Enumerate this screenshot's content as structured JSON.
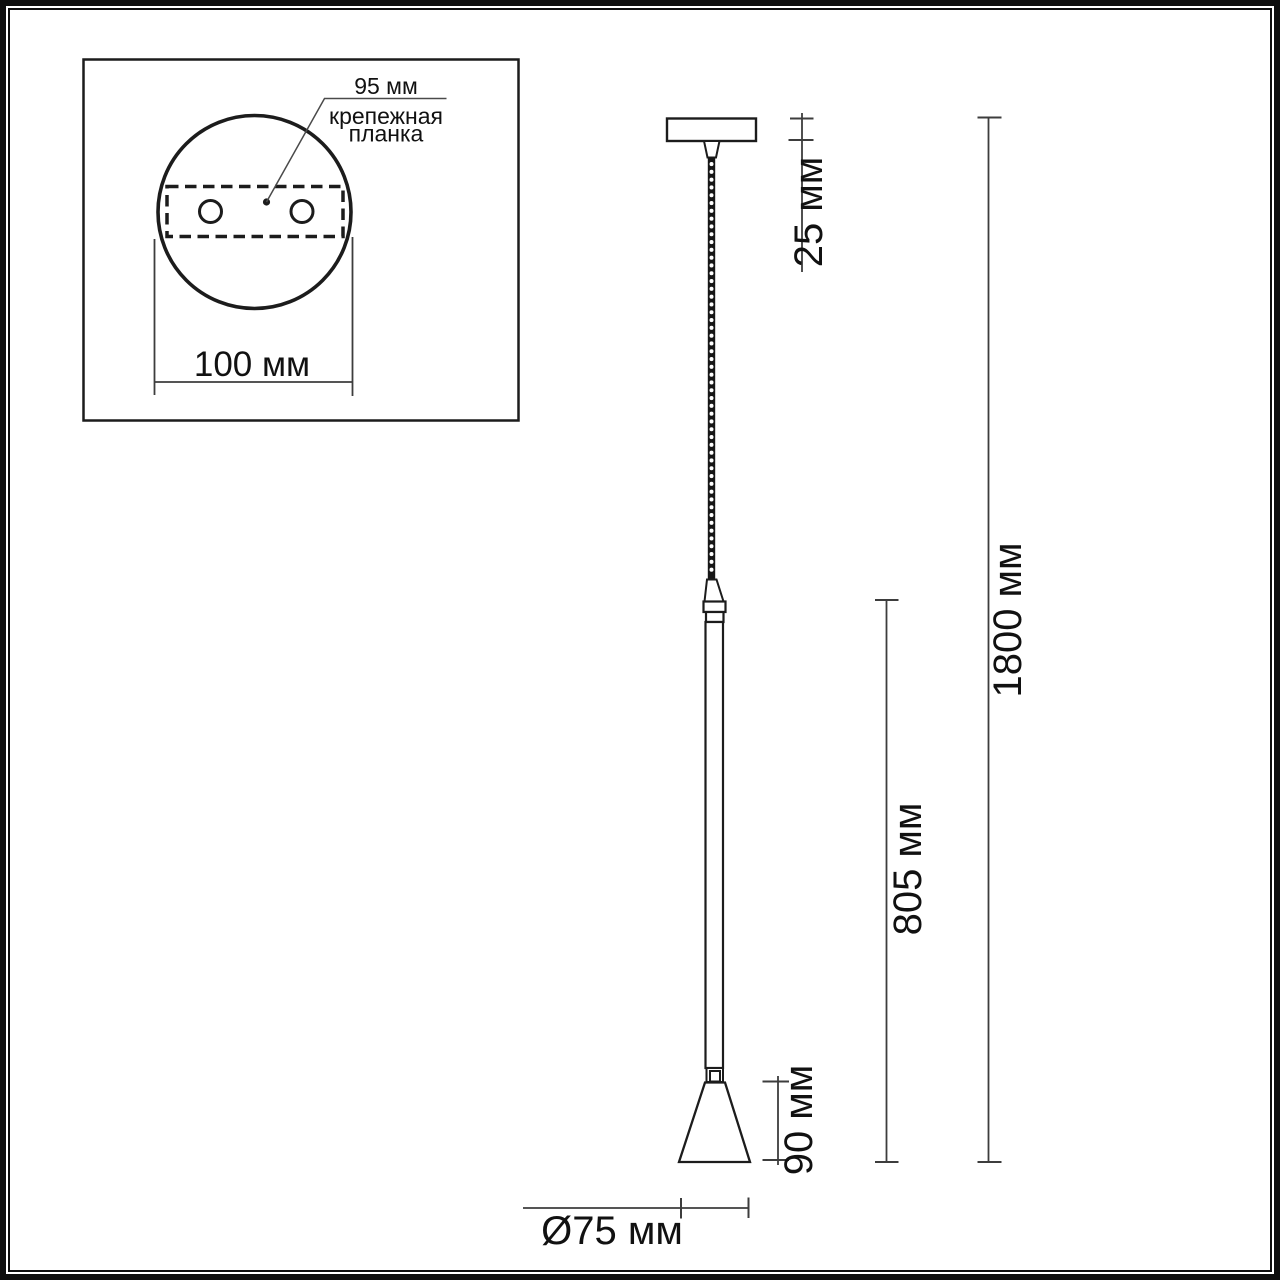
{
  "inset": {
    "plate_size_label": "95 мм",
    "bracket_label_line1": "крепежная",
    "bracket_label_line2": "планка",
    "plate_diameter_label": "100 мм"
  },
  "dimensions": {
    "canopy_height_label": "25 мм",
    "overall_height_label": "1800 мм",
    "rod_length_label": "805 мм",
    "shade_height_label": "90 мм",
    "shade_diameter_label": "Ø75 мм"
  },
  "colors": {
    "outline": "#1c1c1c",
    "dimension_line": "#3d3d3d",
    "text": "#111111",
    "background": "#ffffff"
  }
}
